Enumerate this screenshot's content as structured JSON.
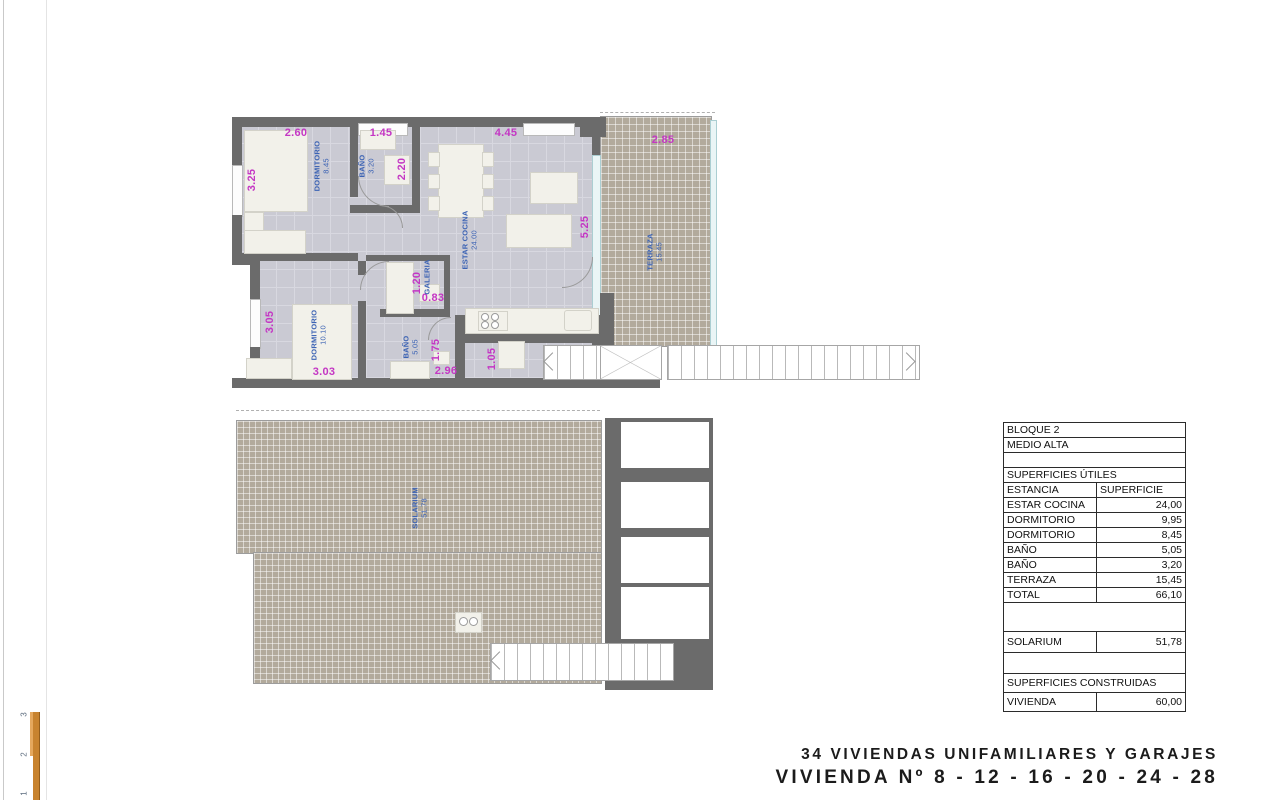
{
  "titles": {
    "line1": "34 VIVIENDAS UNIFAMILIARES Y GARAJES",
    "line2": "VIVIENDA Nº 8 - 12 - 16 - 20 - 24 - 28"
  },
  "colors": {
    "wall": "#6b6b6b",
    "dimension_text": "#c437c4",
    "room_label_text": "#3c63b4",
    "terrace_hatch": "#b2aa9c",
    "floor": "#cacad3",
    "scale_bar": "#c8832f"
  },
  "plan": {
    "dims": [
      "2.60",
      "1.45",
      "4.45",
      "2.85",
      "3.25",
      "2.20",
      "5.25",
      "1.20",
      "0.83",
      "3.05",
      "1.75",
      "3.03",
      "2.96",
      "1.05"
    ],
    "rooms": [
      {
        "name": "DORMITORIO",
        "area": "8.45"
      },
      {
        "name": "BAÑO",
        "area": "3.20"
      },
      {
        "name": "ESTAR COCINA",
        "area": "24.00"
      },
      {
        "name": "GALERIA",
        "area": ""
      },
      {
        "name": "TERRAZA",
        "area": "15.45"
      },
      {
        "name": "DORMITORIO",
        "area": "10.10"
      },
      {
        "name": "BAÑO",
        "area": "5.05"
      },
      {
        "name": "SOLARIUM",
        "area": "51.78"
      }
    ]
  },
  "table": {
    "rows": [
      {
        "label": "BLOQUE 2",
        "value": ""
      },
      {
        "label": "MEDIO ALTA",
        "value": ""
      },
      {
        "label": "",
        "value": ""
      },
      {
        "label": "SUPERFICIES ÚTILES",
        "value": ""
      },
      {
        "label": "ESTANCIA",
        "value": "SUPERFICIE"
      },
      {
        "label": "ESTAR COCINA",
        "value": "24,00"
      },
      {
        "label": "DORMITORIO",
        "value": "9,95"
      },
      {
        "label": "DORMITORIO",
        "value": "8,45"
      },
      {
        "label": "BAÑO",
        "value": "5,05"
      },
      {
        "label": "BAÑO",
        "value": "3,20"
      },
      {
        "label": "TERRAZA",
        "value": "15,45"
      },
      {
        "label": "TOTAL",
        "value": "66,10"
      },
      {
        "label": "",
        "value": ""
      },
      {
        "label": "SOLARIUM",
        "value": "51,78"
      },
      {
        "label": "",
        "value": ""
      },
      {
        "label": "SUPERFICIES CONSTRUIDAS",
        "value": ""
      },
      {
        "label": "VIVIENDA",
        "value": "60,00"
      }
    ]
  },
  "scale": {
    "ticks": [
      "3",
      "2",
      "1"
    ]
  }
}
